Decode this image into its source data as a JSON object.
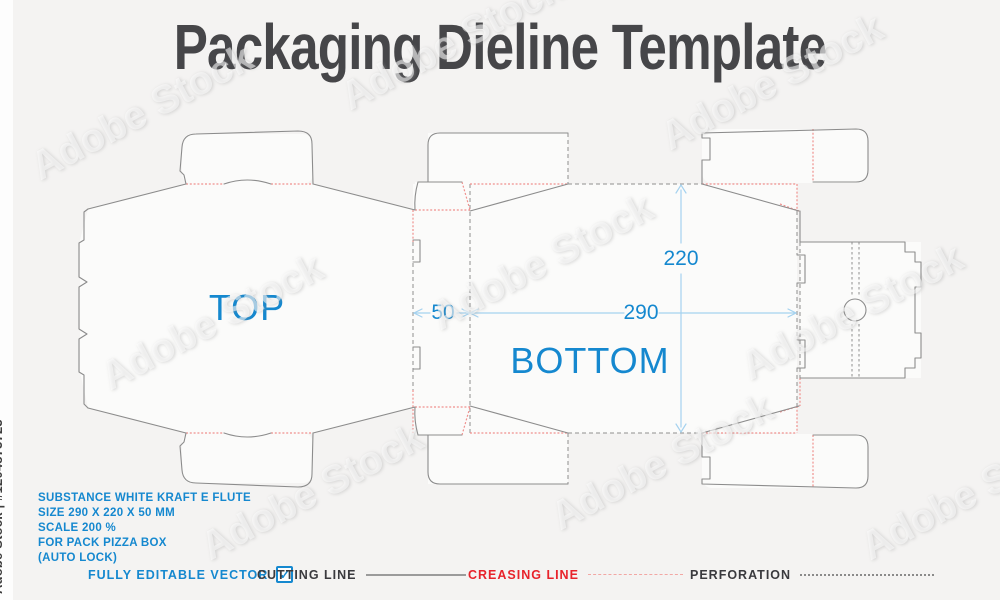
{
  "title": "Packaging Dieline Template",
  "watermark": {
    "vertical": "Adobe Stock | #1204873723",
    "diagonal": "Adobe Stock"
  },
  "dieline": {
    "top_label": "TOP",
    "bottom_label": "BOTTOM",
    "dim_width": "290",
    "dim_height": "220",
    "dim_depth": "50"
  },
  "specs": [
    "SUBSTANCE WHITE KRAFT E FLUTE",
    "SIZE 290 X 220 X 50 MM",
    "SCALE 200 %",
    "FOR PACK PIZZA BOX",
    "(AUTO LOCK)"
  ],
  "legend": {
    "editable_label": "FULLY EDITABLE VECTOR",
    "checkbox_glyph": "✓",
    "cutting_label": "CUTTING LINE",
    "creasing_label": "CREASING LINE",
    "perforation_label": "PERFORATION"
  },
  "colors": {
    "accent_blue": "#1588cf",
    "crease_red": "#e8232b",
    "crease_line_red": "#f0918e",
    "cut_gray": "#8c8c8c",
    "perforation_gray": "#8f8f8f",
    "title_gray": "#464649",
    "dimension_blue": "#a5d2ef"
  }
}
